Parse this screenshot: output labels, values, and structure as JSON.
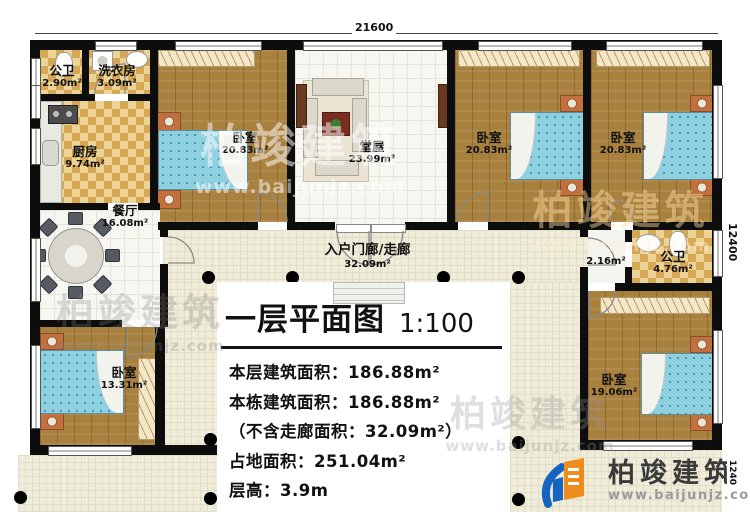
{
  "title": {
    "text": "一层平面图",
    "scale": "1:100"
  },
  "stats": [
    {
      "text": "本层建筑面积：186.88m²"
    },
    {
      "text": "本栋建筑面积：186.88m²"
    },
    {
      "text": "（不含走廊面积：32.09m²）"
    },
    {
      "text": "占地面积：251.04m²"
    },
    {
      "text": "层高：3.9m"
    }
  ],
  "dimensions": {
    "top": "21600",
    "right": "12400",
    "porch": "1240"
  },
  "rooms": {
    "bath1": {
      "name": "公卫",
      "area": "2.90m²"
    },
    "laundry": {
      "name": "洗衣房",
      "area": "3.09m²"
    },
    "kitchen": {
      "name": "厨房",
      "area": "9.74m²"
    },
    "dining": {
      "name": "餐厅",
      "area": "16.08m²"
    },
    "bedroom_sw": {
      "name": "卧室",
      "area": "13.31m²"
    },
    "bedroom_nw": {
      "name": "卧室",
      "area": "20.83m²"
    },
    "hall": {
      "name": "堂屋",
      "area": "23.99m²"
    },
    "bedroom_n2": {
      "name": "卧室",
      "area": "20.83m²"
    },
    "bedroom_ne": {
      "name": "卧室",
      "area": "20.83m²"
    },
    "corridor": {
      "name": "入户门廊/走廊",
      "area": "32.09m²"
    },
    "closet": {
      "area": "2.16m²"
    },
    "bath2": {
      "name": "公卫",
      "area": "4.76m²"
    },
    "bedroom_se": {
      "name": "卧室",
      "area": "19.06m²"
    }
  },
  "logo": {
    "name": "柏竣建筑",
    "url": "www.baijunjz.com"
  },
  "watermark": {
    "brand": "柏竣建筑",
    "url": "www.baijunjz.com"
  }
}
